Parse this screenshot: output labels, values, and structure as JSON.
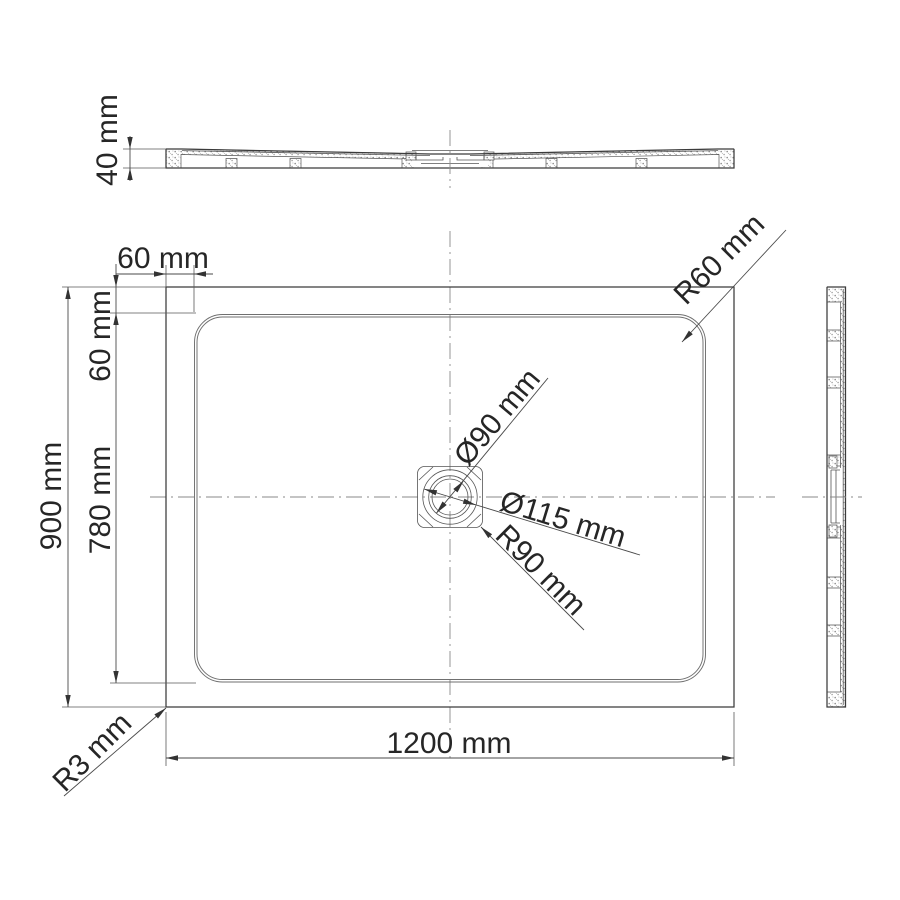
{
  "dimensions": {
    "profile_height": "40 mm",
    "rim_inset_horizontal": "60 mm",
    "rim_inset_vertical": "60 mm",
    "basin_depth": "780 mm",
    "overall_depth": "900 mm",
    "overall_width": "1200 mm",
    "outer_corner_radius": "R3 mm",
    "basin_corner_radius": "R60 mm",
    "drain_inner_diameter": "Ø90 mm",
    "drain_outer_diameter": "Ø115 mm",
    "drain_pocket_radius": "R90 mm"
  },
  "colors": {
    "background": "#ffffff",
    "line": "#3b3b3b",
    "text": "#262626",
    "centerline": "#8a8a8a"
  }
}
